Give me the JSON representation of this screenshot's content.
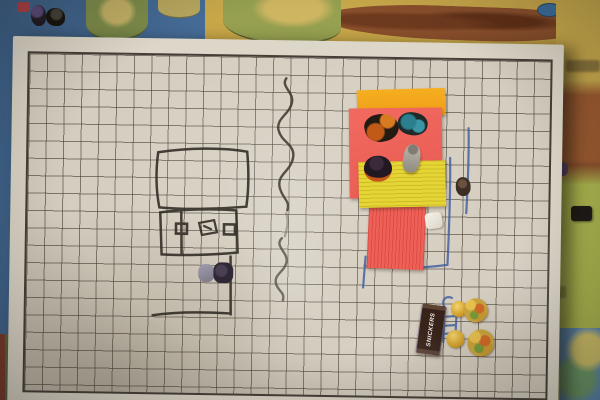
{
  "photo": {
    "wrapper_text": "SNICKERS"
  },
  "colors": {
    "board_surface": "#d5cec0",
    "grid_line": "#48423a",
    "black_marker": "#2f2a23",
    "blue_marker": "#3f5fa0",
    "sticky_orange": "#f3a71e",
    "sticky_red": "#ee6158",
    "sticky_yellow": "#e5d636",
    "map_ocean": "#446a92",
    "map_desert": "#c9ab4d",
    "map_mountains": "#8a4f2c",
    "map_grassland": "#aab44e",
    "snickers_brown": "#38231a",
    "candy_gold": "#d3a02c"
  }
}
